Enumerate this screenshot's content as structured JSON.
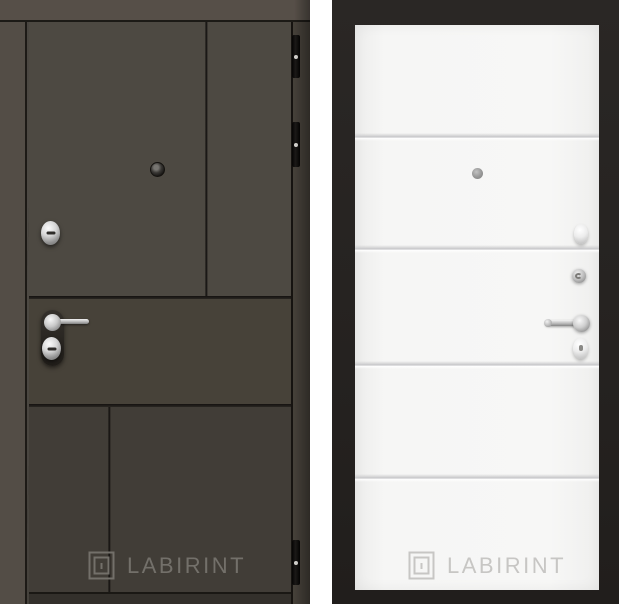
{
  "page": {
    "description": "Product photo of a LABIRINT entrance door: dark wood exterior side on the left, white interior side on a black background on the right",
    "background_color": "#ffffff"
  },
  "brand": {
    "name": "LABIRINT",
    "logo": "labyrinth-square-icon"
  },
  "left_door": {
    "side": "exterior",
    "watermark": "LABIRINT",
    "finish_color": "#4b4741",
    "frame_color": "#534d46",
    "groove_color": "#1a1814",
    "watermark_color": "#73706a",
    "hardware": [
      "peephole",
      "upper-cylinder-lock",
      "lever-handle-with-backplate",
      "lower-cylinder-lock",
      "hinge-top",
      "hinge-middle",
      "hinge-bottom"
    ]
  },
  "right_door": {
    "side": "interior",
    "watermark": "LABIRINT",
    "finish_color": "#f6f6f5",
    "background_color": "#252220",
    "groove_color": "#c9c9cb",
    "watermark_color": "#c7c6c4",
    "hardware": [
      "peephole",
      "upper-escutcheon",
      "thumbturn-knob",
      "lever-handle",
      "keyhole-escutcheon"
    ]
  }
}
